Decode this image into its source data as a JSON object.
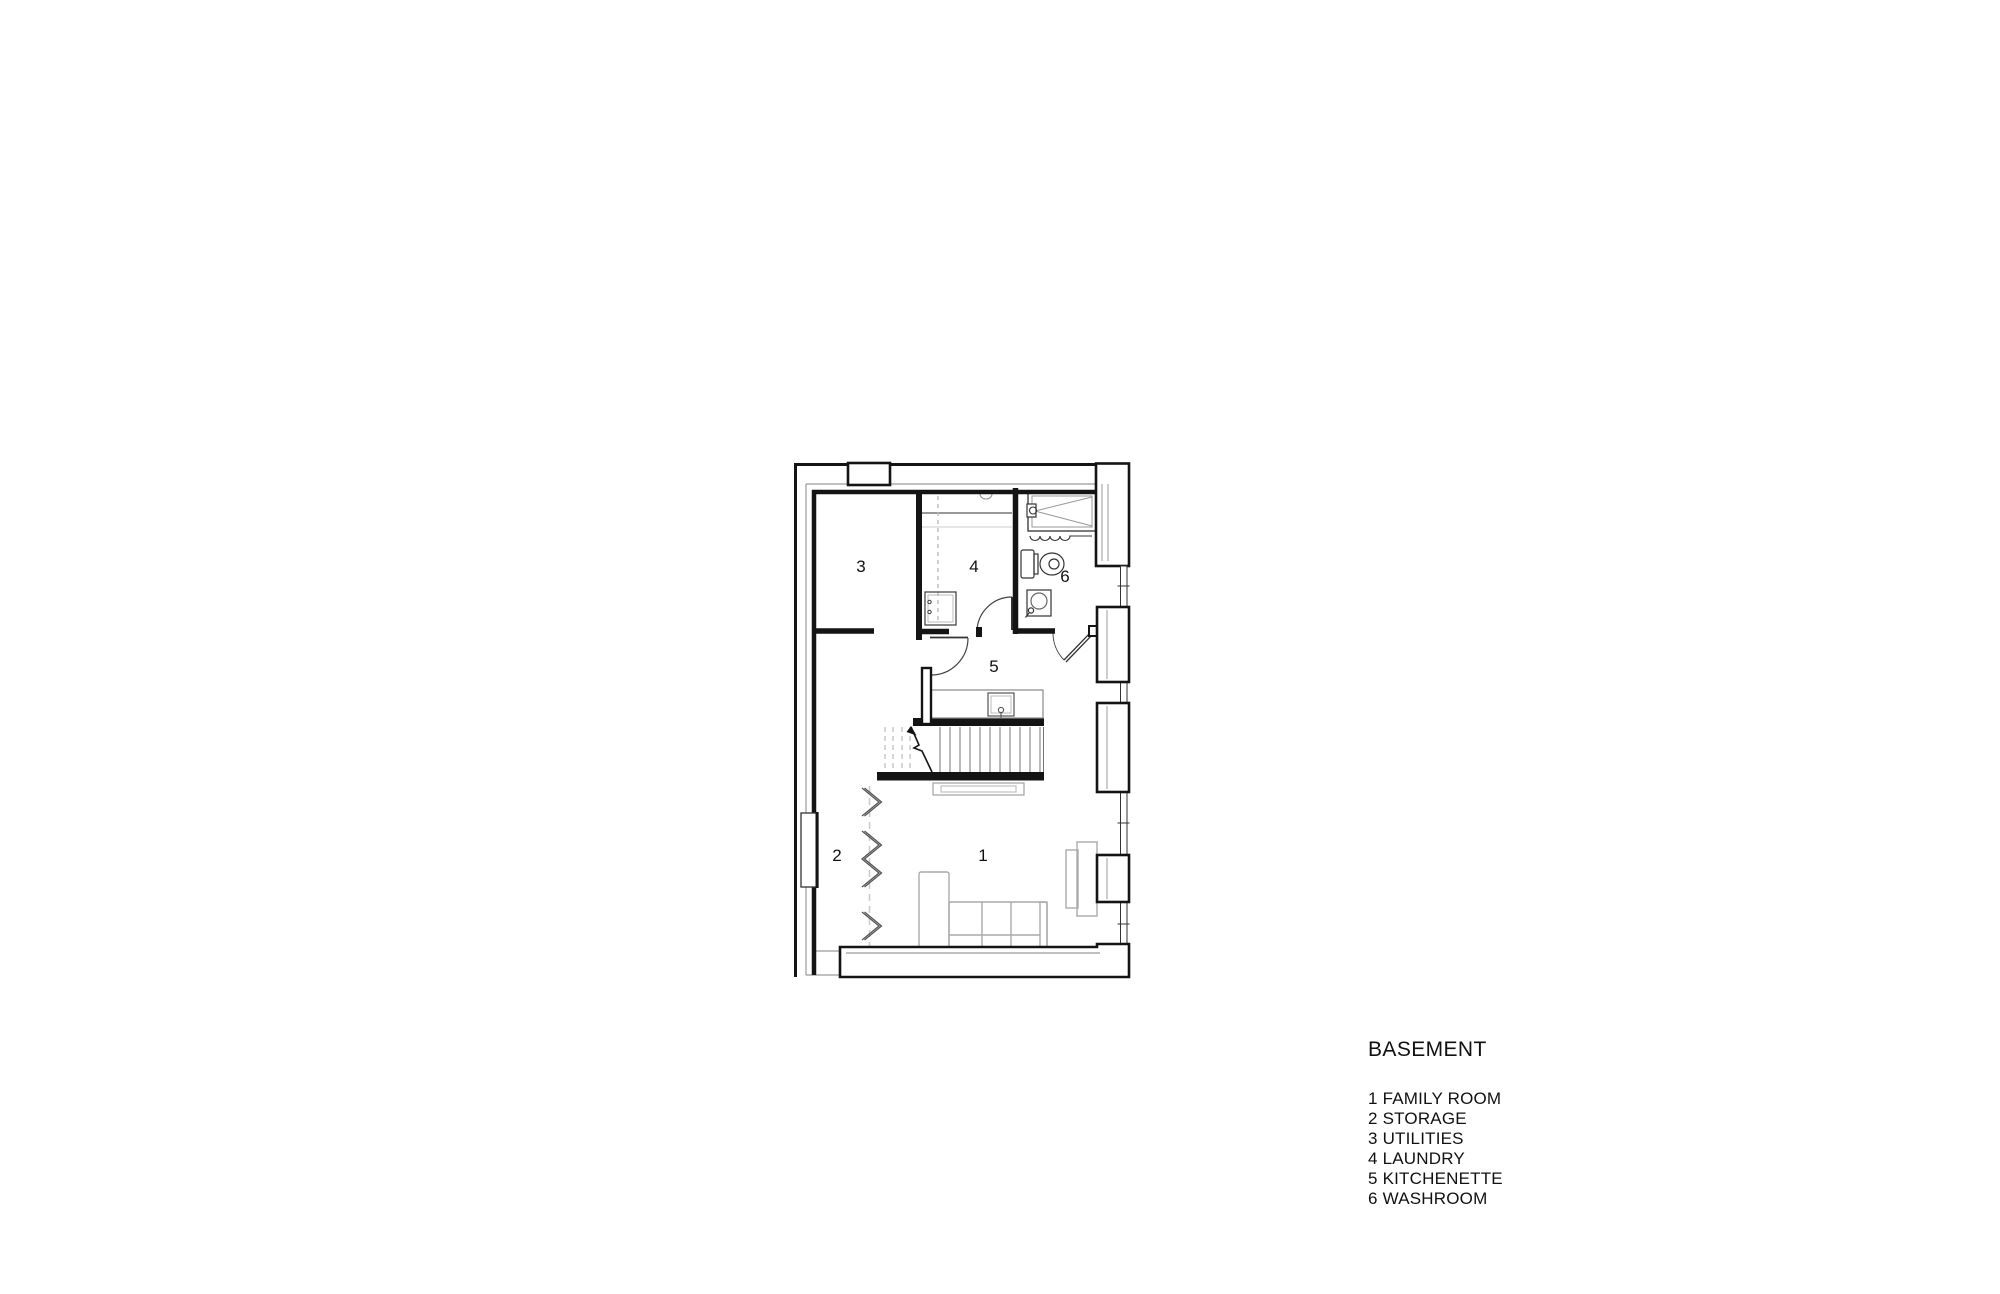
{
  "legend": {
    "title": "BASEMENT",
    "items": [
      "1 FAMILY ROOM",
      "2 STORAGE",
      "3 UTILITIES",
      "4 LAUNDRY",
      "5 KITCHENETTE",
      "6 WASHROOM"
    ]
  },
  "plan": {
    "room_numbers": {
      "family_room": "1",
      "storage": "2",
      "utilities": "3",
      "laundry": "4",
      "kitchenette": "5",
      "washroom": "6"
    }
  },
  "colors": {
    "wall": "#141414",
    "fixture": "#3a3a3a",
    "finish_line": "#9b9b9b",
    "furniture": "#aaaaaa",
    "background": "#ffffff"
  }
}
